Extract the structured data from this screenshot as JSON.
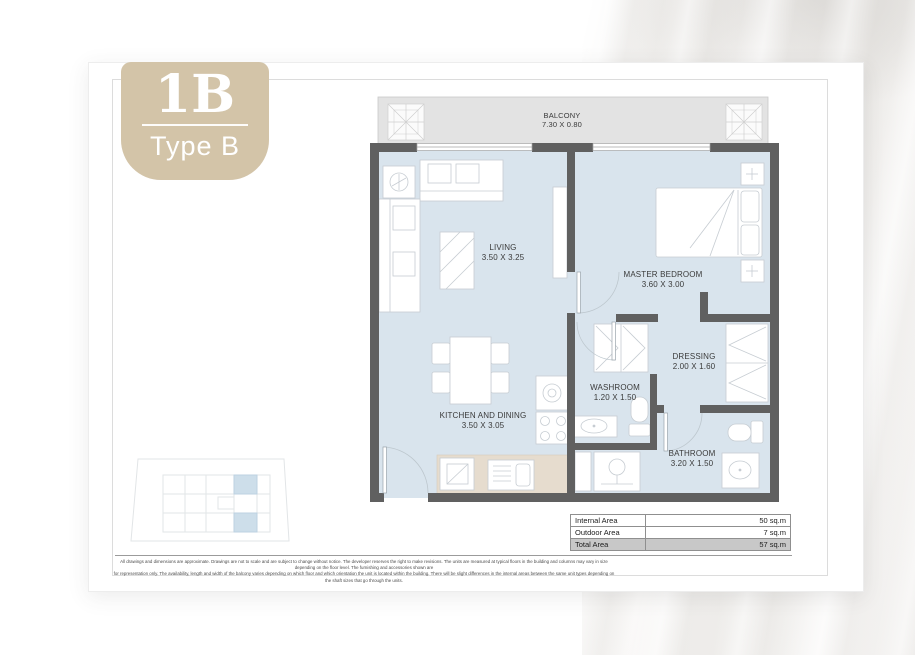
{
  "logo": {
    "code": "1B",
    "type_label": "Type B"
  },
  "plan": {
    "rooms": {
      "balcony": {
        "name": "BALCONY",
        "dims": "7.30 X 0.80"
      },
      "living": {
        "name": "LIVING",
        "dims": "3.50 X 3.25"
      },
      "master_bedroom": {
        "name": "MASTER BEDROOM",
        "dims": "3.60 X 3.00"
      },
      "dressing": {
        "name": "DRESSING",
        "dims": "2.00 X 1.60"
      },
      "washroom": {
        "name": "WASHROOM",
        "dims": "1.20 X 1.50"
      },
      "kitchen_dining": {
        "name": "KITCHEN AND DINING",
        "dims": "3.50 X 3.05"
      },
      "bathroom": {
        "name": "BATHROOM",
        "dims": "3.20 X 1.50"
      }
    }
  },
  "area_table": {
    "rows": [
      {
        "label": "Internal Area",
        "value": "50 sq.m"
      },
      {
        "label": "Outdoor Area",
        "value": "7 sq.m"
      },
      {
        "label": "Total Area",
        "value": "57 sq.m"
      }
    ]
  },
  "disclaimer": {
    "line1": "All drawings and dimensions are approximate. Drawings are not to scale and are subject to change without notice. The developer reserves the right to make revisions. The units are measured at typical floors in the building and columns may vary in size depending on the floor level. The furnishing and accessories shown are",
    "line2": "for representation only. The availability, length and width of the balcony varies depending on which floor and which orientation the unit is located within the building. There will be slight differences in the internal areas between the same unit types depending on the shaft sizes that go through the units."
  },
  "colors": {
    "accent_beige": "#d3c4a8",
    "room_fill": "#d9e4ed",
    "balcony_fill": "#e3e3e3",
    "wall": "#606060",
    "keyplan_highlight": "#cddeea"
  }
}
